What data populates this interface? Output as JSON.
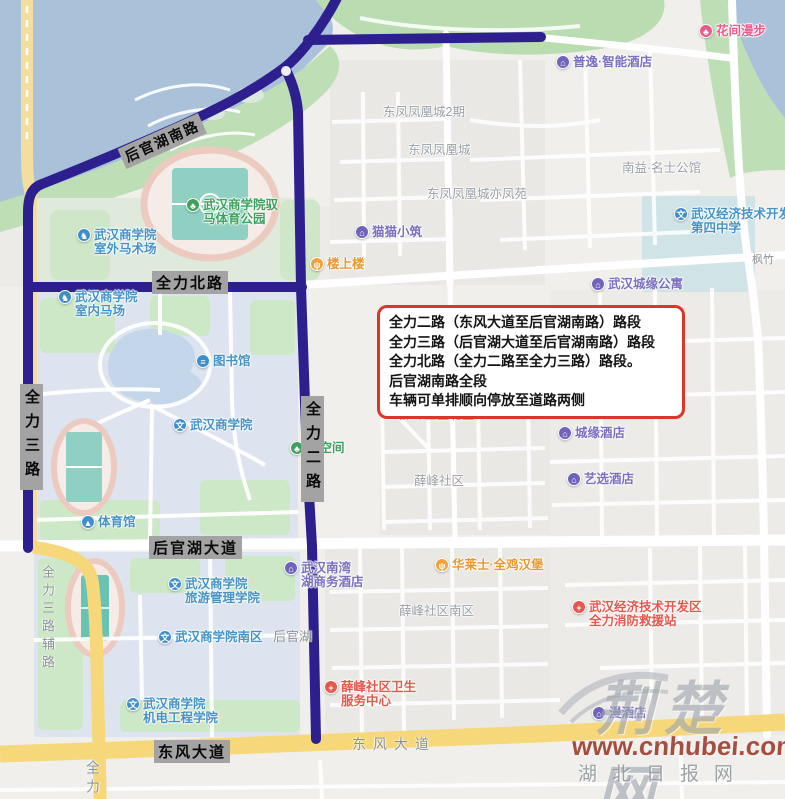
{
  "notice": {
    "text": "全力二路（东风大道至后官湖南路）路段\n全力三路（后官湖大道至后官湖南路）路段\n全力北路（全力二路至全力三路）路段。\n后官湖南路全段\n车辆可单排顺向停放至道路两侧",
    "lines": [
      "全力二路（东风大道至后官湖南路）路段",
      "全力三路（后官湖大道至后官湖南路）路段",
      "全力北路（全力二路至全力三路）路段。",
      "后官湖南路全段",
      "车辆可单排顺向停放至道路两侧"
    ]
  },
  "road_labels": {
    "houguanhu_south": "后官湖南路",
    "quanli_north": "全力北路",
    "quanli_3": "全力三路",
    "quanli_2": "全力二路",
    "houguanhu_avenue": "后官湖大道",
    "dongfeng_avenue": "东风大道",
    "dongfeng_avenue_gray": "东风大道",
    "quanli_3_fulu": "全力三路辅路",
    "quanli_3_bottom": "全力三路",
    "houguanhu_partial": "后官湖",
    "fengzhu": "枫竹"
  },
  "pois": [
    {
      "label": "花间漫步",
      "glyph": "♣",
      "type": "scenic"
    },
    {
      "label": "普逸·智能酒店",
      "glyph": "⌂",
      "type": "hotel"
    },
    {
      "label": "东凤凤凰城2期",
      "type": "area"
    },
    {
      "label": "东凤凤凰城",
      "type": "area"
    },
    {
      "label": "南益·名士公馆",
      "type": "area"
    },
    {
      "label": "东凤凤凰城亦凤苑",
      "type": "area"
    },
    {
      "label": "武汉经济技术开发区\n第四中学",
      "glyph": "文",
      "type": "edu"
    },
    {
      "label": "猫猫小筑",
      "glyph": "⌂",
      "type": "hotel"
    },
    {
      "label": "楼上楼",
      "glyph": "ψ",
      "type": "food"
    },
    {
      "label": "武汉城缘公寓",
      "glyph": "⌂",
      "type": "hotel"
    },
    {
      "label": "武汉商学院驭\n马体育公园",
      "glyph": "♣",
      "type": "park"
    },
    {
      "label": "武汉商学院\n室外马术场",
      "glyph": "♞",
      "type": "edu"
    },
    {
      "label": "武汉商学院\n室内马场",
      "glyph": "♞",
      "type": "edu"
    },
    {
      "label": "图书馆",
      "glyph": "≡",
      "type": "edu"
    },
    {
      "label": "武汉商学院",
      "glyph": "文",
      "type": "edu"
    },
    {
      "label": "枝空间",
      "glyph": "♣",
      "type": "park"
    },
    {
      "label": "体育馆",
      "glyph": "▲",
      "type": "edu"
    },
    {
      "label": "城缘酒店",
      "glyph": "⌂",
      "type": "hotel"
    },
    {
      "label": "艺选酒店",
      "glyph": "⌂",
      "type": "hotel"
    },
    {
      "label": "薛峰社区北区",
      "type": "area"
    },
    {
      "label": "薛峰社区",
      "type": "area"
    },
    {
      "label": "武汉商学院\n旅游管理学院",
      "glyph": "文",
      "type": "edu"
    },
    {
      "label": "武汉南湾\n湖商务酒店",
      "glyph": "⌂",
      "type": "hotel"
    },
    {
      "label": "华莱士·全鸡汉堡",
      "glyph": "ψ",
      "type": "food"
    },
    {
      "label": "薛峰社区南区",
      "type": "area"
    },
    {
      "label": "武汉经济技术开发区\n全力消防救援站",
      "glyph": "+",
      "type": "red"
    },
    {
      "label": "武汉商学院南区",
      "glyph": "文",
      "type": "edu"
    },
    {
      "label": "薛峰社区卫生\n服务中心",
      "glyph": "+",
      "type": "red"
    },
    {
      "label": "武汉商学院\n机电工程学院",
      "glyph": "文",
      "type": "edu"
    },
    {
      "label": "漫酒店",
      "glyph": "⌂",
      "type": "hotel"
    }
  ],
  "watermark": {
    "logo": "荆楚网",
    "url": "www.cnhubei.com",
    "site": "湖北日报网"
  },
  "colors": {
    "restricted_road": "#2e1f8f",
    "main_road_yellow": "#f6d87a",
    "water": "#aac2d9",
    "green": "#bedfb5",
    "campus": "#dde4ef",
    "notice_border": "#dd3526",
    "watermark_red": "#993322"
  }
}
